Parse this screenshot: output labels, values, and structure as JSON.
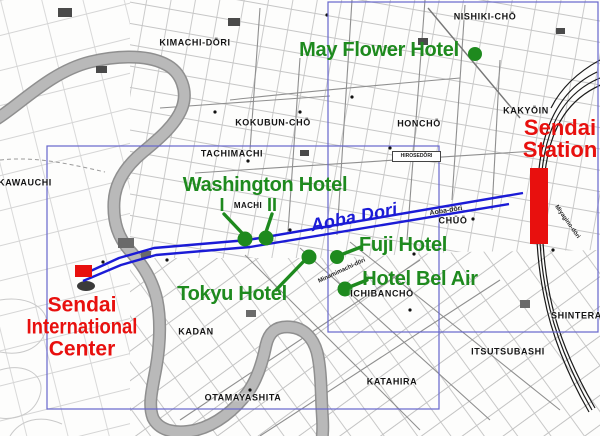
{
  "map_title": "Sendai hotel area map",
  "colors": {
    "hotel_green": "#1e8a1e",
    "landmark_red": "#e8100e",
    "route_blue": "#1b1bd6",
    "frame_blue": "#6666cc",
    "river_gray": "#b3b3b3"
  },
  "districts": [
    {
      "name": "kimachi-dori",
      "label": "KIMACHI-DŌRI"
    },
    {
      "name": "nishiki-cho",
      "label": "NISHIKI-CHŌ"
    },
    {
      "name": "kokubun-cho",
      "label": "KOKUBUN-CHŌ"
    },
    {
      "name": "honcho",
      "label": "HONCHŌ"
    },
    {
      "name": "kakyoin",
      "label": "KAKYŌIN"
    },
    {
      "name": "tachimachi",
      "label": "TACHIMACHI"
    },
    {
      "name": "kawauchi",
      "label": "KAWAUCHI"
    },
    {
      "name": "machi",
      "label": "MACHI"
    },
    {
      "name": "chuo",
      "label": "CHŪŌ"
    },
    {
      "name": "ichibancho",
      "label": "ICHIBANCHŌ"
    },
    {
      "name": "kadan",
      "label": "KADAN"
    },
    {
      "name": "otamayashita",
      "label": "OTAMAYASHITA"
    },
    {
      "name": "itsutsubashi",
      "label": "ITSUTSUBASHI"
    },
    {
      "name": "katahira",
      "label": "KATAHIRA"
    },
    {
      "name": "shintera",
      "label": "SHINTERA"
    }
  ],
  "street_names": [
    {
      "name": "aoba-dori-small",
      "label": "Aoba-dōri"
    },
    {
      "name": "minamimachi-dori",
      "label": "Minamimachi-dōri"
    },
    {
      "name": "miyagino-dori",
      "label": "Miyagino-dōri"
    },
    {
      "name": "hirose-dori",
      "label": "HIROSEDŌRI"
    }
  ],
  "route": {
    "label": "Aoba Dori"
  },
  "hotels": [
    {
      "name": "may-flower-hotel",
      "label": "May Flower Hotel"
    },
    {
      "name": "washington-hotel",
      "label": "Washington Hotel",
      "sub1": "I",
      "sub2": "II"
    },
    {
      "name": "fuji-hotel",
      "label": "Fuji Hotel"
    },
    {
      "name": "tokyu-hotel",
      "label": "Tokyu Hotel"
    },
    {
      "name": "hotel-bel-air",
      "label": "Hotel Bel Air"
    }
  ],
  "landmarks": {
    "station": {
      "line1": "Sendai",
      "line2": "Station"
    },
    "intl_center": {
      "line1": "Sendai",
      "line2": "International",
      "line3": "Center"
    }
  }
}
